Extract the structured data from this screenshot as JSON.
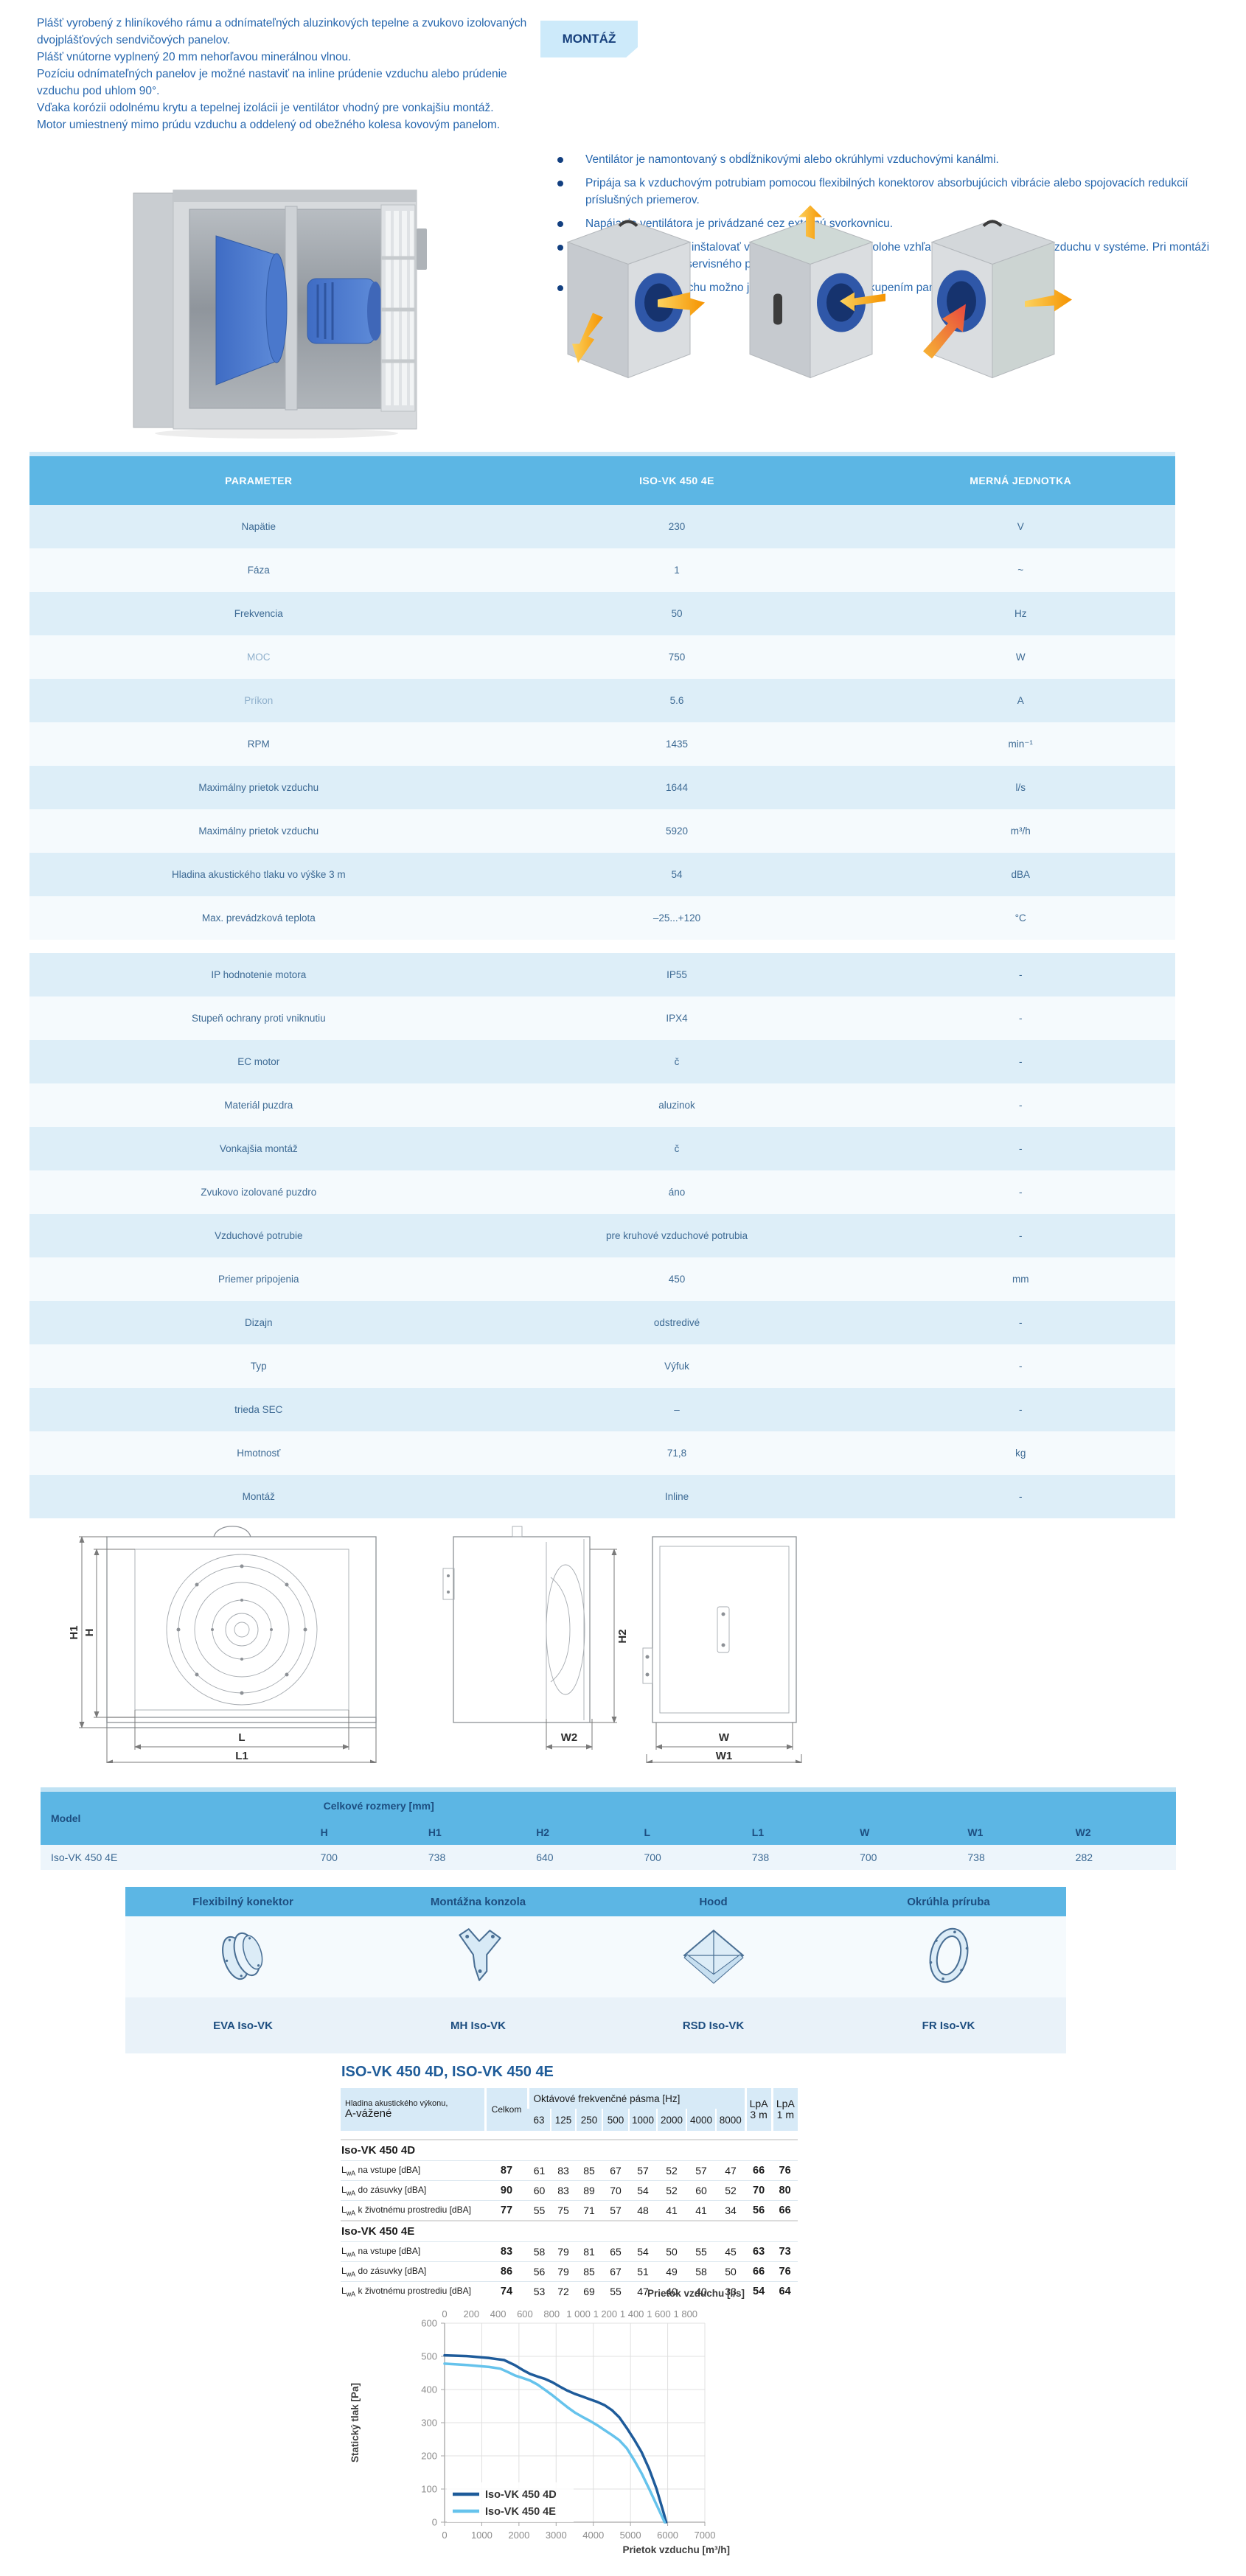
{
  "intro": {
    "lines": [
      "Plášť vyrobený z hliníkového rámu a odnímateľných aluzinkových tepelne a zvukovo izolovaných dvojplášťových sendvičových panelov.",
      "Plášť vnútorne vyplnený 20 mm nehorľavou minerálnou vlnou.",
      "Pozíciu odnímateľných panelov je možné nastaviť na inline prúdenie vzduchu alebo prúdenie vzduchu pod uhlom 90°.",
      "Vďaka korózii odolnému krytu a tepelnej izolácii je ventilátor vhodný pre vonkajšiu montáž.",
      "Motor umiestnený mimo prúdu vzduchu a oddelený od obežného kolesa kovovým panelom."
    ]
  },
  "montaz": {
    "badge": "MONTÁŽ",
    "bullets": [
      "Ventilátor je namontovaný s obdĺžnikovými alebo okrúhlymi vzduchovými kanálmi.",
      "Pripája sa k vzduchovým potrubiam pomocou flexibilných konektorov absorbujúcich vibrácie alebo spojovacích redukcií príslušných priemerov.",
      "Napájanie ventilátora je privádzané cez externú svorkovnicu.",
      "Ventilátory je možné inštalovať v akejkoľvek montážnej polohe vzhľadom na smer prúdenia vzduchu v systéme. Pri montáži poskytnite dostatok servisného priestoru.",
      "Smer prúdenia vzduchu možno jednoducho zmeniť preskupením panelu."
    ]
  },
  "spec_table": {
    "headers": [
      "PARAMETER",
      "ISO-VK 450 4E",
      "MERNÁ JEDNOTKA"
    ],
    "gap_after": 9,
    "rows": [
      {
        "param": "Napätie",
        "value": "230",
        "unit": "V"
      },
      {
        "param": "Fáza",
        "value": "1",
        "unit": "~"
      },
      {
        "param": "Frekvencia",
        "value": "50",
        "unit": "Hz"
      },
      {
        "param": "MOC",
        "value": "750",
        "unit": "W",
        "muted": true
      },
      {
        "param": "Príkon",
        "value": "5.6",
        "unit": "A",
        "muted": true
      },
      {
        "param": "RPM",
        "value": "1435",
        "unit": "min⁻¹"
      },
      {
        "param": "Maximálny prietok vzduchu",
        "value": "1644",
        "unit": "l/s"
      },
      {
        "param": "Maximálny prietok vzduchu",
        "value": "5920",
        "unit": "m³/h"
      },
      {
        "param": "Hladina akustického tlaku vo výške 3 m",
        "value": "54",
        "unit": "dBA"
      },
      {
        "param": "Max. prevádzková teplota",
        "value": "–25...+120",
        "unit": "°C"
      },
      {
        "param": "IP hodnotenie motora",
        "value": "IP55",
        "unit": "-"
      },
      {
        "param": "Stupeň ochrany proti vniknutiu",
        "value": "IPX4",
        "unit": "-"
      },
      {
        "param": "EC motor",
        "value": "č",
        "unit": "-"
      },
      {
        "param": "Materiál puzdra",
        "value": "aluzinok",
        "unit": "-"
      },
      {
        "param": "Vonkajšia montáž",
        "value": "č",
        "unit": "-"
      },
      {
        "param": "Zvukovo izolované puzdro",
        "value": "áno",
        "unit": "-"
      },
      {
        "param": "Vzduchové potrubie",
        "value": "pre kruhové vzduchové potrubia",
        "unit": "-"
      },
      {
        "param": "Priemer pripojenia",
        "value": "450",
        "unit": "mm"
      },
      {
        "param": "Dizajn",
        "value": "odstredivé",
        "unit": "-"
      },
      {
        "param": "Typ",
        "value": "Výfuk",
        "unit": "-"
      },
      {
        "param": "trieda SEC",
        "value": "–",
        "unit": "-"
      },
      {
        "param": "Hmotnosť",
        "value": "71,8",
        "unit": "kg"
      },
      {
        "param": "Montáž",
        "value": "Inline",
        "unit": "-"
      }
    ]
  },
  "drawings": {
    "labels": {
      "h1": "H1",
      "h": "H",
      "l": "L",
      "l1": "L1",
      "h2": "H2",
      "w2": "W2",
      "w": "W",
      "w1": "W1"
    }
  },
  "dims_table": {
    "model_header": "Model",
    "group_header": "Celkové rozmery [mm]",
    "columns": [
      "H",
      "H1",
      "H2",
      "L",
      "L1",
      "W",
      "W1",
      "W2"
    ],
    "row": {
      "model": "Iso-VK 450 4E",
      "values": [
        "700",
        "738",
        "640",
        "700",
        "738",
        "700",
        "738",
        "282"
      ]
    }
  },
  "accessories": {
    "items": [
      {
        "title": "Flexibilný konektor",
        "code": "EVA Iso-VK"
      },
      {
        "title": "Montážna konzola",
        "code": "MH Iso-VK"
      },
      {
        "title": "Hood",
        "code": "RSD Iso-VK"
      },
      {
        "title": "Okrúhla príruba",
        "code": "FR Iso-VK"
      }
    ]
  },
  "acoustic": {
    "title": "ISO-VK 450 4D, ISO-VK 450 4E",
    "header": {
      "label_line1": "Hladina akustického výkonu,",
      "label_line2": "A-vážené",
      "total": "Celkom",
      "octave_title": "Oktávové frekvenčné pásma [Hz]",
      "bands": [
        "63",
        "125",
        "250",
        "500",
        "1000",
        "2000",
        "4000",
        "8000"
      ],
      "lpa3": [
        "LpA",
        "3 m"
      ],
      "lpa1": [
        "LpA",
        "1 m"
      ]
    },
    "sections": [
      {
        "name": "Iso-VK 450 4D",
        "rows": [
          {
            "sub": "wA",
            "label": "na vstupe [dBA]",
            "total": "87",
            "bands": [
              "61",
              "83",
              "85",
              "67",
              "57",
              "52",
              "57",
              "47"
            ],
            "lpa3": "66",
            "lpa1": "76"
          },
          {
            "sub": "wA",
            "label": "do zásuvky [dBA]",
            "total": "90",
            "bands": [
              "60",
              "83",
              "89",
              "70",
              "54",
              "52",
              "60",
              "52"
            ],
            "lpa3": "70",
            "lpa1": "80"
          },
          {
            "sub": "wA",
            "label": "k životnému prostrediu [dBA]",
            "total": "77",
            "bands": [
              "55",
              "75",
              "71",
              "57",
              "48",
              "41",
              "41",
              "34"
            ],
            "lpa3": "56",
            "lpa1": "66"
          }
        ]
      },
      {
        "name": "Iso-VK 450 4E",
        "rows": [
          {
            "sub": "wA",
            "label": "na vstupe [dBA]",
            "total": "83",
            "bands": [
              "58",
              "79",
              "81",
              "65",
              "54",
              "50",
              "55",
              "45"
            ],
            "lpa3": "63",
            "lpa1": "73"
          },
          {
            "sub": "wA",
            "label": "do zásuvky [dBA]",
            "total": "86",
            "bands": [
              "56",
              "79",
              "85",
              "67",
              "51",
              "49",
              "58",
              "50"
            ],
            "lpa3": "66",
            "lpa1": "76"
          },
          {
            "sub": "wA",
            "label": "k životnému prostrediu [dBA]",
            "total": "74",
            "bands": [
              "53",
              "72",
              "69",
              "55",
              "47",
              "40",
              "40",
              "33"
            ],
            "lpa3": "54",
            "lpa1": "64"
          }
        ]
      }
    ]
  },
  "chart_data": {
    "type": "line",
    "x_bottom": {
      "label": "Prietok vzduchu [m³/h]",
      "range": [
        0,
        7000
      ],
      "ticks": [
        0,
        1000,
        2000,
        3000,
        4000,
        5000,
        6000,
        7000
      ]
    },
    "x_top": {
      "label": "Prietok vzduchu [l/s]",
      "scale_to_bottom": 3.6,
      "ticks": [
        0,
        200,
        400,
        600,
        800,
        1000,
        1200,
        1400,
        1600,
        1800
      ],
      "tick_labels": [
        "0",
        "200",
        "400",
        "600",
        "800",
        "1 000",
        "1 200",
        "1 400",
        "1 600",
        "1 800"
      ]
    },
    "y": {
      "label": "Statický tlak [Pa]",
      "range": [
        0,
        600
      ],
      "ticks": [
        0,
        100,
        200,
        300,
        400,
        500,
        600
      ]
    },
    "grid": true,
    "legend_position": "bottom-left-inside",
    "series": [
      {
        "name": "Iso-VK 450 4D",
        "color": "#1e5b9a",
        "points": [
          [
            0,
            503
          ],
          [
            600,
            501
          ],
          [
            1200,
            495
          ],
          [
            1600,
            489
          ],
          [
            1900,
            473
          ],
          [
            2100,
            459
          ],
          [
            2300,
            447
          ],
          [
            2500,
            439
          ],
          [
            2700,
            432
          ],
          [
            2900,
            422
          ],
          [
            3100,
            409
          ],
          [
            3300,
            397
          ],
          [
            3500,
            387
          ],
          [
            3700,
            379
          ],
          [
            3900,
            371
          ],
          [
            4100,
            363
          ],
          [
            4300,
            353
          ],
          [
            4500,
            338
          ],
          [
            4700,
            316
          ],
          [
            4900,
            284
          ],
          [
            5100,
            249
          ],
          [
            5300,
            211
          ],
          [
            5500,
            161
          ],
          [
            5700,
            101
          ],
          [
            5900,
            25
          ],
          [
            5960,
            0
          ]
        ]
      },
      {
        "name": "Iso-VK 450 4E",
        "color": "#66c3ec",
        "points": [
          [
            0,
            478
          ],
          [
            600,
            474
          ],
          [
            1200,
            468
          ],
          [
            1500,
            463
          ],
          [
            1700,
            453
          ],
          [
            1900,
            442
          ],
          [
            2100,
            435
          ],
          [
            2300,
            427
          ],
          [
            2500,
            415
          ],
          [
            2700,
            399
          ],
          [
            2900,
            383
          ],
          [
            3100,
            365
          ],
          [
            3300,
            347
          ],
          [
            3500,
            331
          ],
          [
            3700,
            318
          ],
          [
            3900,
            306
          ],
          [
            4100,
            293
          ],
          [
            4300,
            278
          ],
          [
            4500,
            263
          ],
          [
            4700,
            247
          ],
          [
            4900,
            223
          ],
          [
            5100,
            187
          ],
          [
            5300,
            147
          ],
          [
            5500,
            101
          ],
          [
            5700,
            53
          ],
          [
            5920,
            0
          ]
        ]
      }
    ]
  }
}
